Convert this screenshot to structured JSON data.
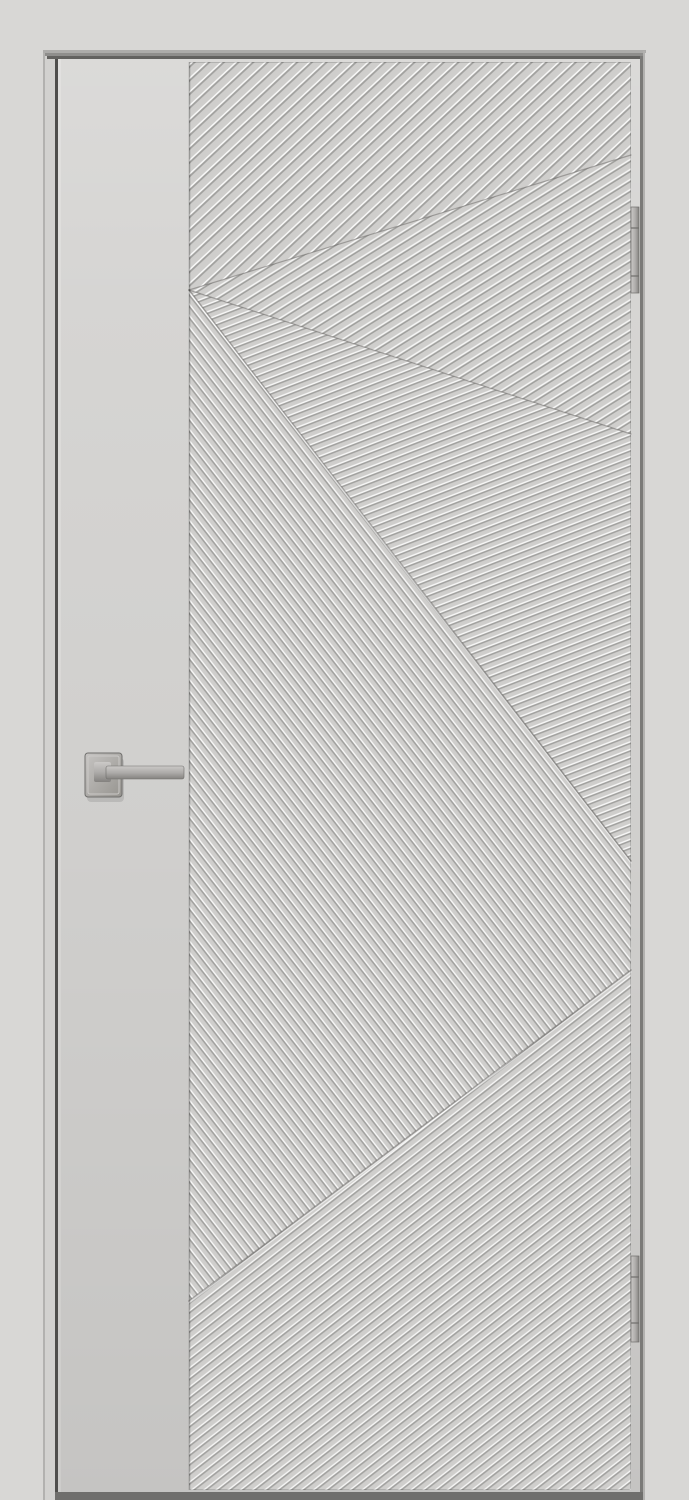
{
  "scene": {
    "kind": "interior-door-product-photo",
    "door_leaf": {
      "x": 58,
      "y": 59,
      "w": 582,
      "h": 1433
    },
    "stile_plain": {
      "x": 58,
      "y": 59,
      "w": 131,
      "h": 1433
    },
    "panel": {
      "x": 189,
      "y": 62,
      "w": 442,
      "h": 1428
    }
  },
  "colors": {
    "wall": "#d8d7d5",
    "jamb_face": "#d2d1cf",
    "jamb_edge_line": "#b2b1af",
    "gap_dark_left": "#4f4e4c",
    "gap_dark_right": "#7b7a78",
    "header_line_light": "#adacaa",
    "header_line_mid": "#8f8e8c",
    "header_line_dark": "#636260",
    "leaf_base": "#d4d3d1",
    "leaf_edge_highlight": "#dcdbd9",
    "panel_base": "#cfcecc",
    "panel_edge_shadow": "rgba(0,0,0,0.14)",
    "groove_highlight": "rgba(255,255,255,0.85)",
    "groove_shadow": "rgba(96,95,93,0.42)",
    "boundary_shadow": "rgba(90,89,87,0.45)",
    "boundary_light": "rgba(255,255,255,0.55)",
    "metal_light": "#cbc9c7",
    "metal_mid": "#aeacaa",
    "metal_dark": "#84827f",
    "metal_edge": "#6f6e6c",
    "rose_light": "#c6c4c2",
    "rose_dark": "#96948f",
    "bottom_shadow": "#6f6e6c"
  },
  "pattern_fields": {
    "top45": {
      "points": "0,0 442,0 442,93 0,228",
      "transform": "rotate(-43)",
      "spacing": 10
    },
    "mid33": {
      "points": "0,228 442,93 442,372",
      "transform": "rotate(-32)",
      "spacing": 8.5
    },
    "low21": {
      "points": "0,228 442,372 442,799",
      "transform": "rotate(-21)",
      "spacing": 7
    },
    "steep": {
      "points": "0,228 442,799 442,908 0,1239",
      "transform": "rotate(52)",
      "spacing": 7
    },
    "bottom": {
      "points": "0,1239 442,908 442,1428 0,1428",
      "transform": "rotate(-38)",
      "spacing": 7.5
    }
  },
  "field_boundaries": {
    "b1": "0,228 442,93",
    "b2": "0,228 442,372",
    "sb": "0,228 442,799",
    "bb": "0,1239 442,908"
  },
  "handle": {
    "rose": {
      "x": 85,
      "y": 753,
      "w": 37,
      "h": 44,
      "rx": 3
    },
    "rose_inner": {
      "x": 88,
      "y": 756,
      "w": 31,
      "h": 38,
      "rx": 2
    },
    "stem": {
      "x": 94,
      "y": 762,
      "w": 17,
      "h": 20,
      "rx": 2
    },
    "bar": {
      "x": 106,
      "y": 766,
      "w": 78,
      "h": 13,
      "rx": 2
    }
  },
  "hinges": {
    "top": {
      "x": 631,
      "y": 207,
      "w": 8,
      "h": 86,
      "joint1_y": 228,
      "joint2_y": 276
    },
    "bottom": {
      "x": 631,
      "y": 1256,
      "w": 8,
      "h": 86,
      "joint1_y": 1277,
      "joint2_y": 1323
    }
  }
}
